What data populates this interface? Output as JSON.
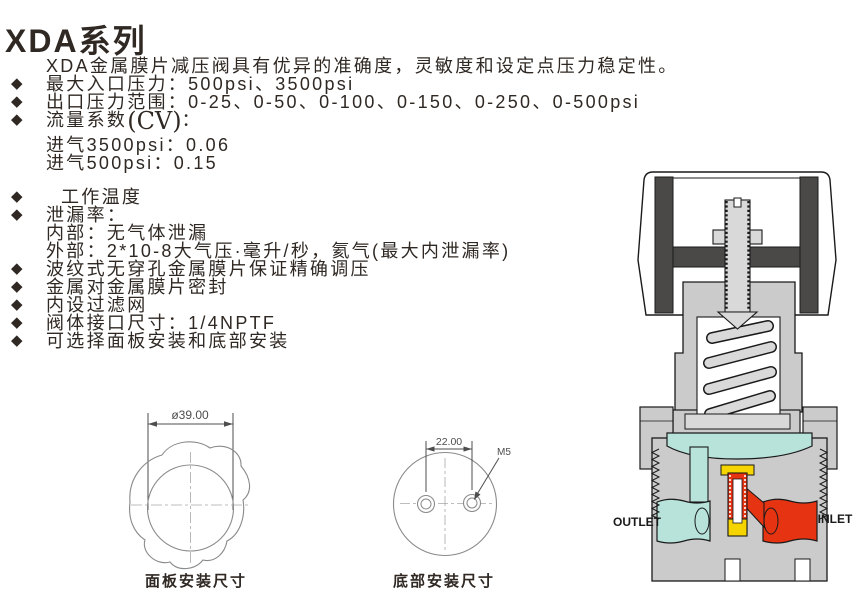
{
  "page": {
    "title": "XDA系列"
  },
  "colors": {
    "text": "#2f2823",
    "outline": "#1a1a1a",
    "body-gray": "#cbcbcb",
    "light-gray": "#d9d9d9",
    "knob-dark": "#4b4947",
    "outlet-teal": "#b7e3da",
    "inlet-red": "#e63312",
    "seat-yellow": "#f5d400",
    "line-gray": "#8a8a8a"
  },
  "features": {
    "bullet_char": "◆",
    "items": [
      {
        "bullet": false,
        "text": "XDA金属膜片减压阀具有优异的准确度，灵敏度和设定点压力稳定性。"
      },
      {
        "bullet": true,
        "text": "最大入口压力：500psi、3500psi"
      },
      {
        "bullet": true,
        "text": "出口压力范围：0-25、0-50、0-100、0-150、0-250、0-500psi"
      },
      {
        "bullet": true,
        "text": "流量系数",
        "cv": "(CV)",
        "suffix": "："
      },
      {
        "bullet": false,
        "text": "进气3500psi：0.06"
      },
      {
        "bullet": false,
        "text": "进气500psi：0.15"
      },
      {
        "bullet": true,
        "text": "工作温度"
      },
      {
        "bullet": true,
        "text": "泄漏率："
      },
      {
        "bullet": false,
        "text": "内部：无气体泄漏"
      },
      {
        "bullet": false,
        "text": "外部：2*10-8大气压·毫升/秒，氦气(最大内泄漏率)"
      },
      {
        "bullet": true,
        "text": "波纹式无穿孔金属膜片保证精确调压"
      },
      {
        "bullet": true,
        "text": "金属对金属膜片密封"
      },
      {
        "bullet": true,
        "text": "内设过滤网"
      },
      {
        "bullet": true,
        "text": "阀体接口尺寸：1/4NPTF"
      },
      {
        "bullet": true,
        "text": "可选择面板安装和底部安装"
      }
    ]
  },
  "drawings": {
    "panel": {
      "dimension": "ø39.00",
      "caption": "面板安装尺寸"
    },
    "bottom": {
      "dimension": "22.00",
      "thread_label": "M5",
      "caption": "底部安装尺寸"
    }
  },
  "valve": {
    "outlet_label": "OUTLET",
    "inlet_label": "INLET"
  }
}
